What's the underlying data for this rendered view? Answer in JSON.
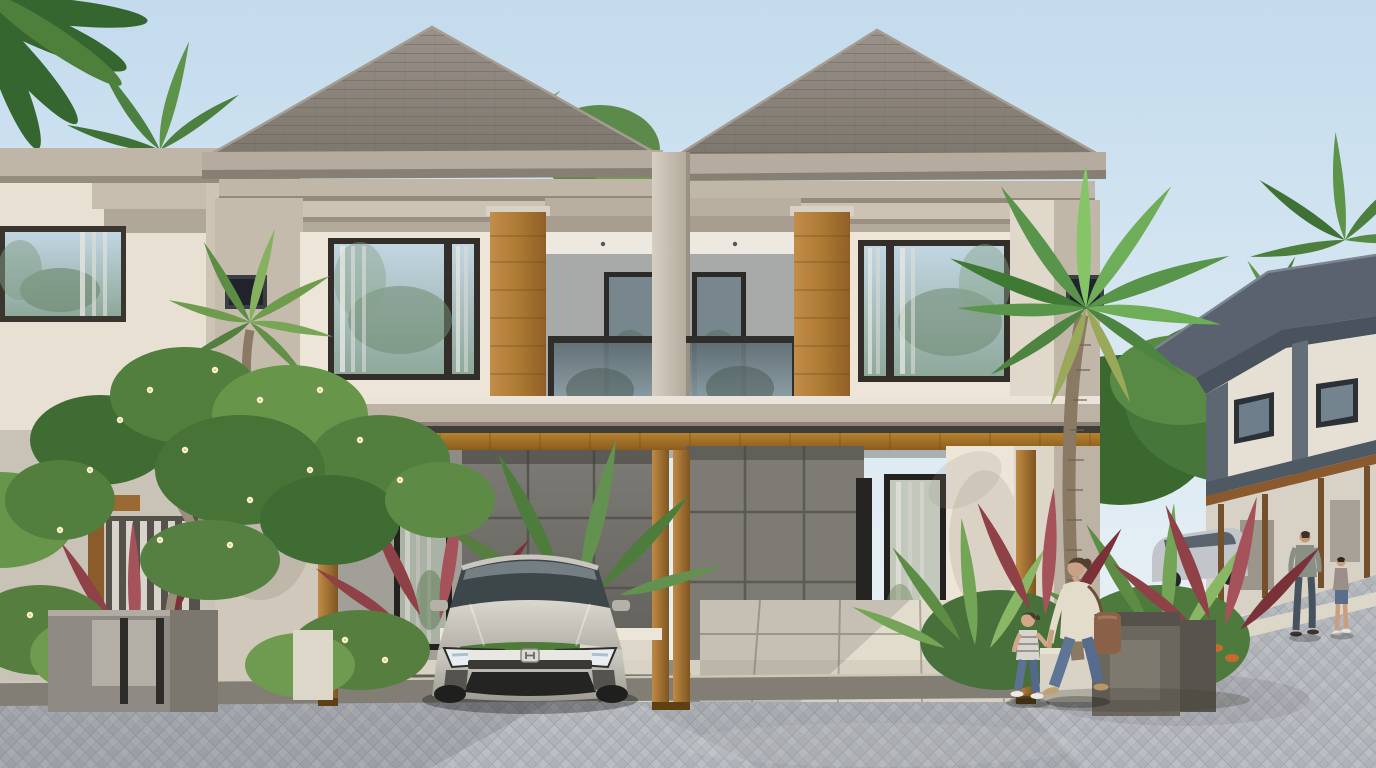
{
  "scene": {
    "title": "Twin two-storey tropical modern houses",
    "description": "Photorealistic architectural rendering of a symmetrical two-unit modern tropical house with hip roofs, cream facades, wooden accent panels, glass balconies and a shared wooden carport canopy. A silver sedan is parked in the left carport. A landscaped front yard holds a frangipani tree, red cordyline, shrubs, stone gate pillars and tall palms. A woman holding a child's hand walks along the paver street; a man and a boy walk near a receding row of similar houses on the right under a light blue sky.",
    "time_of_day": "daytime",
    "weather": "clear"
  },
  "buildings": {
    "main_duplex": {
      "storeys": 2,
      "units": 2,
      "roof": "grey hip roofs with layered cornice fascias",
      "features": [
        "upper-floor picture windows",
        "vertical wood accent panels",
        "recessed glass-railed balconies",
        "central divider column",
        "wooden carport canopy on timber posts",
        "dark panelled carport walls",
        "tall ground-floor windows"
      ]
    },
    "left_neighbour": "partially visible matching unit at left edge with slatted ground-floor window",
    "distant_row": "row of two-storey houses with slate blue-grey roofs and timber pergolas receding to the right, silver car parked beneath"
  },
  "vehicles": [
    {
      "type": "silver sedan",
      "badge": "H emblem",
      "location": "left carport, facing street"
    },
    {
      "type": "silver car",
      "location": "background driveway of distant row"
    }
  ],
  "people": [
    {
      "who": "woman",
      "outfit": "cream top, blue jeans, brown shoulder bag, tan flats",
      "action": "walking left while holding child's hand"
    },
    {
      "who": "child",
      "outfit": "grey striped tee and jeans",
      "action": "walking beside woman"
    },
    {
      "who": "man",
      "outfit": "grey polo and dark jeans",
      "action": "walking in background"
    },
    {
      "who": "boy",
      "outfit": "printed tee and denim shorts",
      "action": "walking beside man"
    }
  ],
  "vegetation": [
    "frangipani tree with white-yellow blossoms",
    "red cordyline shrubs",
    "green shrubs with white flowers",
    "banana foliage",
    "tall coconut palms",
    "background tree masses"
  ],
  "hardscape": [
    "herringbone paver street",
    "granite curb strip",
    "large-tile driveway aprons",
    "granite gate pillars",
    "low white planter walls"
  ],
  "palette": {
    "sky_top": "#c3dbed",
    "sky_horizon": "#eef3f5",
    "roof": "#877f75",
    "fascia": "#b5ab9e",
    "wall_cream": "#ece5d8",
    "wall_grey": "#a19f98",
    "panel_dark": "#75736d",
    "wood_accent": "#ad7a33",
    "canopy_wood": "#a9732e",
    "window_frame": "#2e2b27",
    "glass_reflection": "#9fb4c2",
    "balcony_glass": "#6b7d85",
    "street_paver": "#b5b8bd",
    "driveway_tile": "#d6d0c3",
    "curb": "#827e76",
    "foliage_green": "#5d8c45",
    "cordyline_red": "#8e4147",
    "car_silver": "#c9c6be",
    "stone_pillar": "#8f8b84",
    "distant_trim": "#5d6772"
  }
}
